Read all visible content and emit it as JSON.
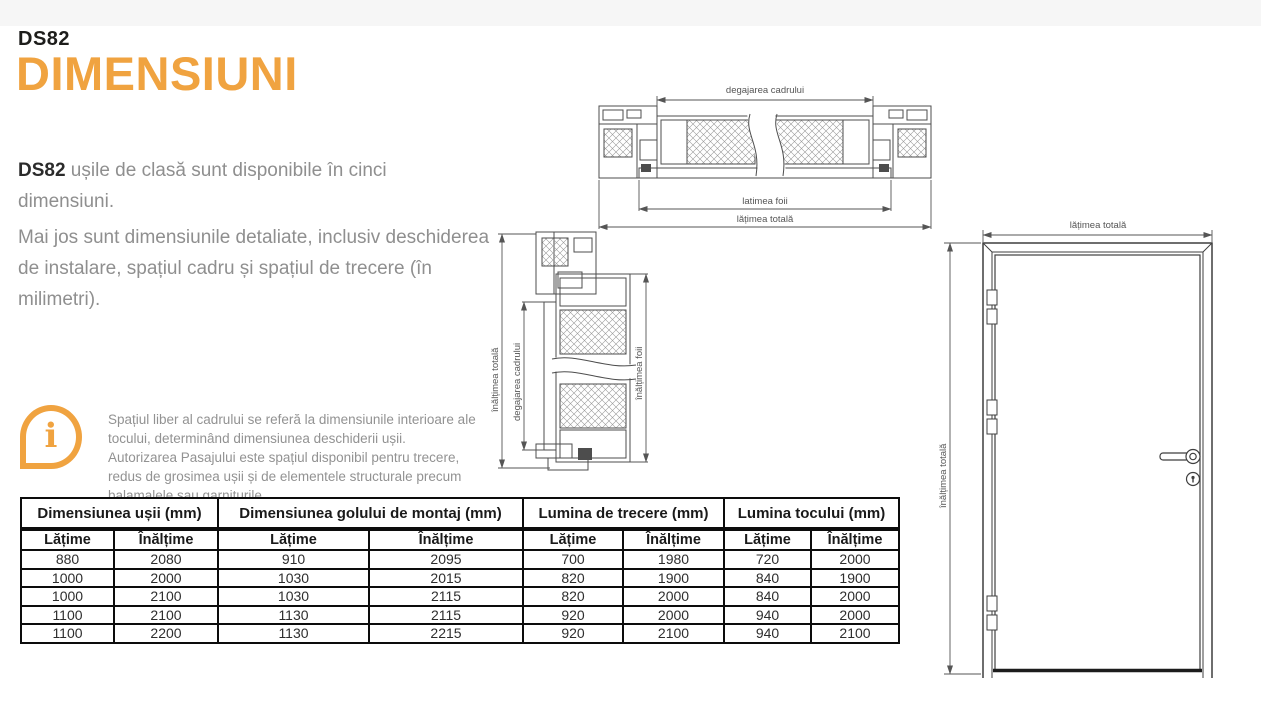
{
  "colors": {
    "accent": "#F0A340",
    "text_dark": "#1d1d1b",
    "text_gray": "#8f8f8f",
    "table_border": "#0c0c0c"
  },
  "header": {
    "kicker": "DS82",
    "title": "DIMENSIUNI"
  },
  "intro": {
    "bold": "DS82",
    "rest": " ușile de clasă sunt disponibile în cinci dimensiuni."
  },
  "description": "Mai jos sunt dimensiunile detaliate, inclusiv deschiderea de instalare, spațiul cadru și spațiul de trecere (în milimetri).",
  "note": {
    "icon_glyph": "i",
    "line1": "Spațiul liber al cadrului se referă la dimensiunile interioare ale tocului, determinând dimensiunea deschiderii ușii.",
    "line2": "Autorizarea Pasajului este spațiul disponibil pentru trecere, redus de grosimea ușii și de elementele structurale precum balamalele sau garniturile."
  },
  "drawings": {
    "horizontal_section": {
      "dim_top": "degajarea cadrului",
      "dim_leaf": "latimea foii",
      "dim_total": "lățimea totală"
    },
    "vertical_section": {
      "dim_total": "înălțimea totală",
      "dim_frame": "degajarea cadrului",
      "dim_leaf": "înălțimea foii"
    },
    "door_front": {
      "dim_width": "lățimea totală",
      "dim_height": "înălțimea totală"
    }
  },
  "table": {
    "groups": [
      {
        "label": "Dimensiunea ușii (mm)"
      },
      {
        "label": "Dimensiunea golului de montaj (mm)"
      },
      {
        "label": "Lumina de trecere (mm)"
      },
      {
        "label": "Lumina tocului (mm)"
      }
    ],
    "subheaders": [
      "Lățime",
      "Înălțime",
      "Lățime",
      "Înălțime",
      "Lățime",
      "Înălțime",
      "Lățime",
      "Înălțime"
    ],
    "rows": [
      [
        "880",
        "2080",
        "910",
        "2095",
        "700",
        "1980",
        "720",
        "2000"
      ],
      [
        "1000",
        "2000",
        "1030",
        "2015",
        "820",
        "1900",
        "840",
        "1900"
      ],
      [
        "1000",
        "2100",
        "1030",
        "2115",
        "820",
        "2000",
        "840",
        "2000"
      ],
      [
        "1100",
        "2100",
        "1130",
        "2115",
        "920",
        "2000",
        "940",
        "2000"
      ],
      [
        "1100",
        "2200",
        "1130",
        "2215",
        "920",
        "2100",
        "940",
        "2100"
      ]
    ]
  }
}
